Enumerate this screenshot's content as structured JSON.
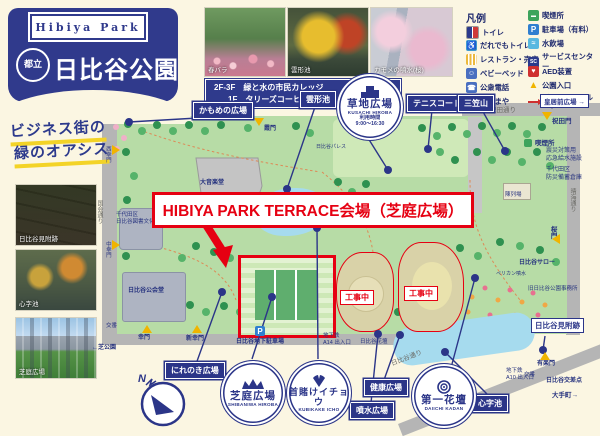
{
  "colors": {
    "navy": "#2b3588",
    "red": "#e60012",
    "cream": "#fbf6e2",
    "park_green": "#b7dca6",
    "pond_blue": "#a6dbee",
    "yellow_underline": "#f3d327",
    "road_gray": "#b5b5b5",
    "construction_tan": "#d9d2a8"
  },
  "header": {
    "ribbon": "Hibiya Park",
    "prefix": "都立",
    "title": "日比谷公園"
  },
  "slogan": {
    "line1": "ビジネス街の",
    "line2": "緑のオアシス"
  },
  "college": {
    "line1": "2F-3F　緑と水の市民カレッジ",
    "line2": "1F　タリーズコーヒー"
  },
  "photos_top": [
    {
      "caption": "春バラ"
    },
    {
      "caption": "雲形池"
    },
    {
      "caption": "カモメの噴水(桜)"
    }
  ],
  "photos_left": [
    {
      "caption": "日比谷見附跡"
    },
    {
      "caption": "心字池"
    },
    {
      "caption": "芝庭広場"
    }
  ],
  "legend": {
    "title": "凡例",
    "left": [
      {
        "label": "トイレ",
        "icon": "toilet",
        "glyph": ""
      },
      {
        "label": "だれでもトイレ",
        "icon": "accessible-toilet",
        "glyph": "♿"
      },
      {
        "label": "レストラン・売店",
        "icon": "restaurant-shop",
        "glyph": ""
      },
      {
        "label": "ベビーベッド",
        "icon": "baby-bed",
        "glyph": "☺"
      },
      {
        "label": "公衆電話",
        "icon": "public-phone",
        "glyph": "☎"
      },
      {
        "label": "あずまや",
        "icon": "gazebo",
        "glyph": "⌂"
      }
    ],
    "right": [
      {
        "label": "喫煙所",
        "icon": "smoking-area",
        "glyph": "▬"
      },
      {
        "label": "駐車場（有料）",
        "icon": "parking-paid",
        "glyph": "P"
      },
      {
        "label": "水飲場",
        "icon": "drinking-water",
        "glyph": "≈"
      },
      {
        "label": "サービスセンター",
        "icon": "service-center",
        "glyph": "SC"
      },
      {
        "label": "AED装置",
        "icon": "aed",
        "glyph": "♥"
      },
      {
        "label": "公園入口",
        "icon": "park-entrance",
        "glyph": "▲"
      },
      {
        "label": "バリアフリールート",
        "icon": "barrier-free-route",
        "glyph": ""
      }
    ]
  },
  "highlight": {
    "title": "HIBIYA PARK TERRACE会場（芝庭広場）",
    "construction": "工事中"
  },
  "circles": {
    "kusachi": {
      "name": "草地広場",
      "roman": "KUSACHI HIROBA",
      "hours_label": "利用時間",
      "hours": "9:00～16:30"
    },
    "shibaniwa": {
      "name": "芝庭広場",
      "roman": "SHIBANIWA HIROBA"
    },
    "kubikake": {
      "name": "首賭けイチョウ",
      "roman": "KUBIKAKE ICHO"
    },
    "daiichi": {
      "name": "第一花壇",
      "roman": "DAIICHI KADAN"
    }
  },
  "compass": {
    "n": "N"
  },
  "labels": {
    "kamome": "かもめの広場",
    "kumogata": "雲形池",
    "tennis": "テニスコート",
    "mikasa": "三笠山",
    "nirenoki": "にれのき広場",
    "kenko": "健康広場",
    "funsui": "噴水広場",
    "shinji": "心字池",
    "kokyo": "皇居前広場 →",
    "mitsuke": "日比谷見附跡",
    "iwaida_dori": "祝田通り",
    "iwaida_mon": "祝田門",
    "kitsuenjo": "喫煙所",
    "shinsai1": "震災対策用",
    "shinsai2": "応急給水施設",
    "bosai1": "千代田区",
    "bosai2": "防災備蓄倉庫",
    "sakuramon": "桜門",
    "harumi_dori": "晴海通り",
    "chinretsujo": "陳列場",
    "saroh": "日比谷サロー",
    "kyujimusho": "旧日比谷公園事務所",
    "pelican": "ペリカン噴水",
    "service_center": "サービスセンター",
    "matsumotoro": "松本楼",
    "kasumimon": "霞門",
    "palace": "日比谷パレス",
    "library1": "千代田区",
    "library2": "日比谷図書文化館",
    "kokaido": "日比谷公会堂",
    "daionogakudo": "大音楽堂",
    "nishisaiwaimon": "西幸門",
    "kokkai_dori": "国会通り",
    "nakasaiwaimon": "中幸門",
    "saiwaimon": "幸門",
    "shinsaiwaimon": "新幸門",
    "koban": "交番",
    "shibakoen": "←芝公園",
    "p_mark": "P",
    "chika_parking": "日比谷地下駐車場",
    "chikatetsu": "地下鉄",
    "a14": "A14 出入口",
    "a10": "A10 出入口",
    "hibiya_kadan": "日比谷花壇",
    "yurakumon": "有楽門",
    "kosaten": "日比谷交差点",
    "otemachi": "大手町→",
    "hibiya_dori": "日比谷通り"
  }
}
